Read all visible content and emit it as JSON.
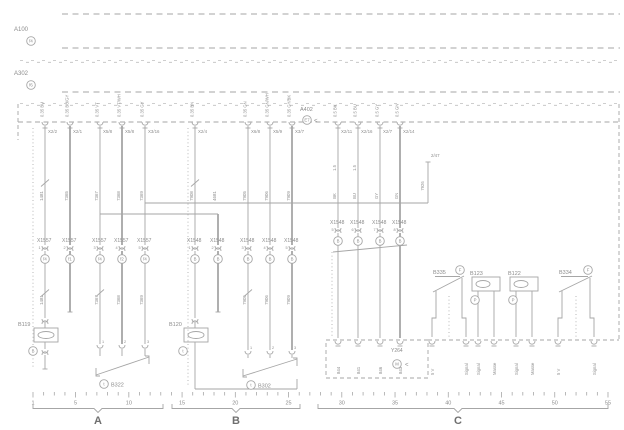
{
  "colors": {
    "line": "#a6a6a6",
    "text": "#8c8c8c",
    "dark": "#6f6f6f",
    "bg": "#ffffff"
  },
  "modules": {
    "a100": {
      "label": "A100",
      "sub": "f4"
    },
    "a302": {
      "label": "A302",
      "sub": "f6"
    },
    "a402": {
      "label": "A402",
      "sub": "E7",
      "arrow": "<"
    }
  },
  "sectionA": {
    "columns": [
      {
        "x": 45,
        "top": "X2/2",
        "topwire": "0.35 BU",
        "wire": "1481",
        "conn": "X1557",
        "pin": "1",
        "sub": "f4",
        "thick": false,
        "wire2": "1481"
      },
      {
        "x": 70,
        "top": "X2/1",
        "topwire": "0.35 BU/GY",
        "wire": "7365",
        "conn": "X1557",
        "pin": "2",
        "sub": "f1",
        "thick": true,
        "wire2": ""
      },
      {
        "x": 100,
        "top": "X5/8",
        "topwire": "0.35 VT",
        "wire": "7367",
        "conn": "X1557",
        "pin": "3",
        "sub": "f4",
        "thick": false,
        "wire2": "7367"
      },
      {
        "x": 122,
        "top": "X5/8",
        "topwire": "0.35 VT/WH",
        "wire": "7368",
        "conn": "X1557",
        "pin": "4",
        "sub": "f2",
        "thick": true,
        "wire2": "7368"
      },
      {
        "x": 145,
        "top": "X3/16",
        "topwire": "0.35 GY",
        "wire": "7369",
        "conn": "X1557",
        "pin": "5",
        "sub": "f4",
        "thick": false,
        "wire2": "7369"
      }
    ],
    "b119": {
      "label": "B119",
      "sub": "B"
    },
    "b322": {
      "label": "B322",
      "sub": "t",
      "pins": [
        "1",
        "2",
        "3"
      ]
    }
  },
  "sectionB": {
    "columns": [
      {
        "x": 195,
        "top": "X2/4",
        "topwire": "0.35 BN",
        "wire": "7908",
        "conn": "X1548",
        "pin": "1",
        "sub": "B",
        "thick": false,
        "wire2": ""
      },
      {
        "x": 218,
        "top": "",
        "topwire": "",
        "wire": "4681",
        "conn": "X1548",
        "pin": "2",
        "sub": "B",
        "thick": true,
        "wire2": ""
      },
      {
        "x": 248,
        "top": "X6/8",
        "topwire": "0.35 GN",
        "wire": "7905",
        "conn": "X1548",
        "pin": "3",
        "sub": "B",
        "thick": false,
        "wire2": "7905"
      },
      {
        "x": 270,
        "top": "X5/9",
        "topwire": "0.35 GN/WH",
        "wire": "7906",
        "conn": "X1548",
        "pin": "4",
        "sub": "B",
        "thick": false,
        "wire2": "7906"
      },
      {
        "x": 292,
        "top": "X3/7",
        "topwire": "0.35 GY/BK",
        "wire": "7909",
        "conn": "X1548",
        "pin": "5",
        "sub": "B",
        "thick": true,
        "wire2": "7909"
      }
    ],
    "b120": {
      "label": "B120",
      "sub": "t"
    },
    "b302": {
      "label": "B302",
      "sub": "t",
      "pins": [
        "1",
        "2",
        "3"
      ]
    }
  },
  "sectionC": {
    "columns": [
      {
        "x": 338,
        "top": "X2/11",
        "topwire": "0.5 BK",
        "size": "1.5",
        "color": "BK",
        "conn": "X1548",
        "pin": "5",
        "sub": "B",
        "code": "844",
        "thick": false
      },
      {
        "x": 358,
        "top": "X2/16",
        "topwire": "0.5 BU",
        "size": "1.5",
        "color": "BU",
        "conn": "X1548",
        "pin": "6",
        "sub": "B",
        "code": "841",
        "thick": false
      },
      {
        "x": 380,
        "top": "X2/7",
        "topwire": "0.5 GY",
        "size": "",
        "color": "GY",
        "conn": "X1548",
        "pin": "7",
        "sub": "B",
        "code": "846",
        "thick": false
      },
      {
        "x": 400,
        "top": "X2/14",
        "topwire": "0.5 GN",
        "size": "",
        "color": "GN",
        "conn": "X1548",
        "pin": "8",
        "sub": "B",
        "code": "843",
        "thick": true
      }
    ],
    "ref": {
      "label": "2/47",
      "wire": "7926"
    },
    "y264": {
      "label": "Y264",
      "sub": "M",
      "arrow": "<",
      "codes": [
        "844",
        "841",
        "846",
        "843"
      ]
    },
    "devices": [
      {
        "label": "B335",
        "sub": "F",
        "type": "pot",
        "legs": [
          "5 V",
          "Signal"
        ]
      },
      {
        "label": "B123",
        "sub": "P",
        "type": "oval",
        "legs": [
          "Signal",
          "Masse"
        ]
      },
      {
        "label": "B122",
        "sub": "P",
        "type": "oval",
        "legs": [
          "Signal",
          "Masse"
        ]
      },
      {
        "label": "B334",
        "sub": "F",
        "type": "pot",
        "legs": [
          "5 V",
          "Signal"
        ]
      }
    ]
  },
  "ruler": {
    "ticks": [
      "1",
      "5",
      "10",
      "15",
      "20",
      "25",
      "30",
      "35",
      "40",
      "45",
      "50",
      "55"
    ],
    "sections": [
      "A",
      "B",
      "C"
    ]
  }
}
